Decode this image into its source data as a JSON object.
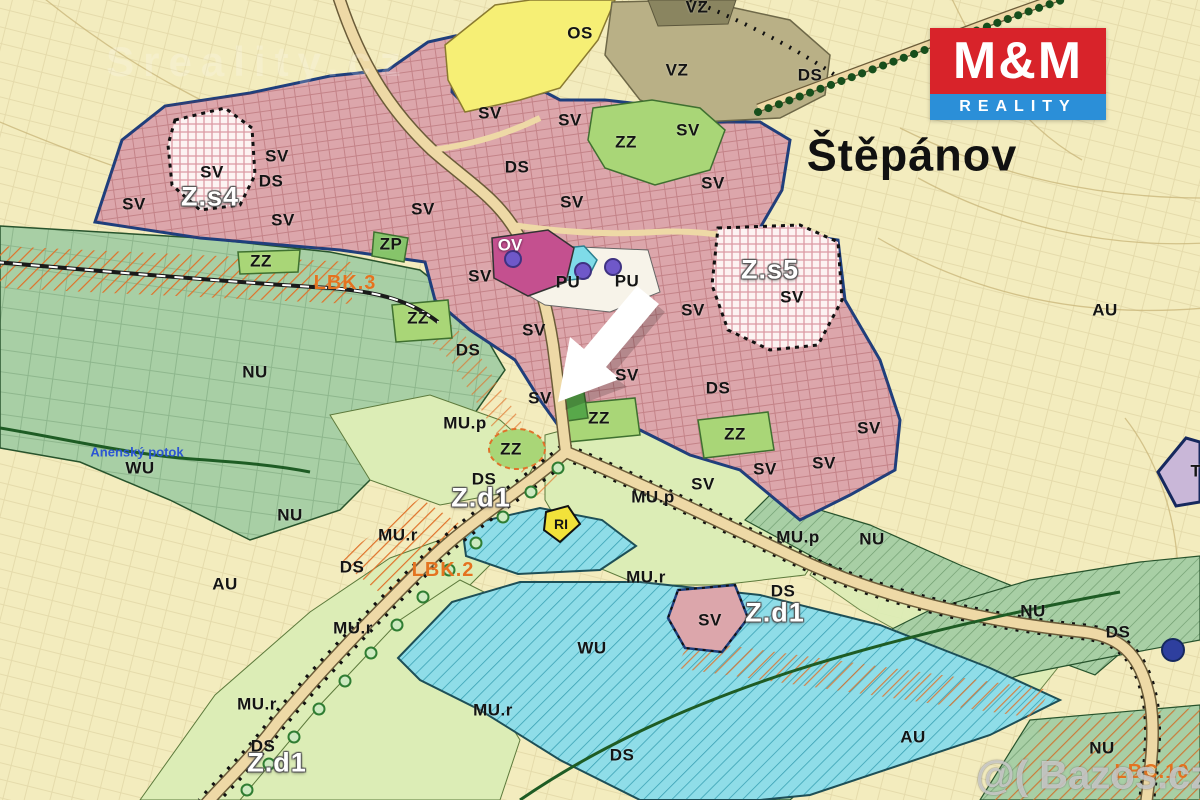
{
  "map": {
    "title": "Štěpánov",
    "logo": {
      "line1": "M&M",
      "line2": "REALITY",
      "red": "#d8232a",
      "blue": "#2b8fd8"
    },
    "watermarks": {
      "top_left": "Sreality.cz",
      "bottom_right": "@( Bazos.cz"
    },
    "colors": {
      "sv_pink": "#dca6ab",
      "nu_sage": "#a8cfa5",
      "mu_pale_green": "#dcedb6",
      "zz_green": "#a9d677",
      "zp_green": "#86c46a",
      "wu_cyan": "#8fdde8",
      "os_yellow": "#f6ef75",
      "vz_khaki": "#b9b086",
      "ov_magenta": "#c4508f",
      "pu_white": "#f7f3e9",
      "au_cream": "#f3ecbe",
      "road_tan": "#eed9a6",
      "corridor_orange": "#e0722a",
      "boundary_navy": "#1e3f7d",
      "ri_yellow": "#f2e23a",
      "t_lavender": "#c9b7d8",
      "marker_purple": "#6f58c9",
      "marker_blue": "#2e3f9e",
      "arrow_white": "#ffffff"
    },
    "labels": [
      {
        "t": "OS",
        "x": 580,
        "y": 33,
        "k": "zone"
      },
      {
        "t": "VZ",
        "x": 697,
        "y": 7,
        "k": "zone"
      },
      {
        "t": "VZ",
        "x": 677,
        "y": 70,
        "k": "zone"
      },
      {
        "t": "DS",
        "x": 810,
        "y": 75,
        "k": "zone"
      },
      {
        "t": "SV",
        "x": 490,
        "y": 113,
        "k": "zone"
      },
      {
        "t": "SV",
        "x": 570,
        "y": 120,
        "k": "zone"
      },
      {
        "t": "SV",
        "x": 688,
        "y": 130,
        "k": "zone"
      },
      {
        "t": "ZZ",
        "x": 626,
        "y": 142,
        "k": "zone"
      },
      {
        "t": "SV",
        "x": 277,
        "y": 156,
        "k": "zone"
      },
      {
        "t": "DS",
        "x": 517,
        "y": 167,
        "k": "zone"
      },
      {
        "t": "SV",
        "x": 212,
        "y": 172,
        "k": "zone"
      },
      {
        "t": "DS",
        "x": 271,
        "y": 181,
        "k": "zone"
      },
      {
        "t": "SV",
        "x": 713,
        "y": 183,
        "k": "zone"
      },
      {
        "t": "Z.s4",
        "x": 210,
        "y": 197,
        "k": "white"
      },
      {
        "t": "SV",
        "x": 134,
        "y": 204,
        "k": "zone"
      },
      {
        "t": "SV",
        "x": 423,
        "y": 209,
        "k": "zone"
      },
      {
        "t": "SV",
        "x": 283,
        "y": 220,
        "k": "zone"
      },
      {
        "t": "SV",
        "x": 572,
        "y": 202,
        "k": "zone"
      },
      {
        "t": "ZP",
        "x": 391,
        "y": 244,
        "k": "zone"
      },
      {
        "t": "OV",
        "x": 510,
        "y": 245,
        "k": "ltwhite"
      },
      {
        "t": "ZZ",
        "x": 261,
        "y": 261,
        "k": "zone"
      },
      {
        "t": "Z.s5",
        "x": 770,
        "y": 270,
        "k": "white"
      },
      {
        "t": "LBK.3",
        "x": 345,
        "y": 283,
        "k": "orange"
      },
      {
        "t": "PU",
        "x": 568,
        "y": 282,
        "k": "zone"
      },
      {
        "t": "PU",
        "x": 627,
        "y": 281,
        "k": "zone"
      },
      {
        "t": "SV",
        "x": 480,
        "y": 276,
        "k": "zone"
      },
      {
        "t": "SV",
        "x": 792,
        "y": 297,
        "k": "zone"
      },
      {
        "t": "SV",
        "x": 693,
        "y": 310,
        "k": "zone"
      },
      {
        "t": "AU",
        "x": 1105,
        "y": 310,
        "k": "zone"
      },
      {
        "t": "ZZ",
        "x": 418,
        "y": 318,
        "k": "zone"
      },
      {
        "t": "SV",
        "x": 534,
        "y": 330,
        "k": "zone"
      },
      {
        "t": "DS",
        "x": 468,
        "y": 350,
        "k": "zone"
      },
      {
        "t": "NU",
        "x": 255,
        "y": 372,
        "k": "zone"
      },
      {
        "t": "SV",
        "x": 627,
        "y": 375,
        "k": "zone"
      },
      {
        "t": "DS",
        "x": 718,
        "y": 388,
        "k": "zone"
      },
      {
        "t": "SV",
        "x": 540,
        "y": 398,
        "k": "zone"
      },
      {
        "t": "ZZ",
        "x": 599,
        "y": 418,
        "k": "zone"
      },
      {
        "t": "MU.p",
        "x": 465,
        "y": 423,
        "k": "zone"
      },
      {
        "t": "SV",
        "x": 869,
        "y": 428,
        "k": "zone"
      },
      {
        "t": "ZZ",
        "x": 735,
        "y": 434,
        "k": "zone"
      },
      {
        "t": "ZZ",
        "x": 511,
        "y": 449,
        "k": "zone"
      },
      {
        "t": "Anenský potok",
        "x": 137,
        "y": 452,
        "k": "stream"
      },
      {
        "t": "SV",
        "x": 824,
        "y": 463,
        "k": "zone"
      },
      {
        "t": "WU",
        "x": 140,
        "y": 468,
        "k": "zone"
      },
      {
        "t": "SV",
        "x": 765,
        "y": 469,
        "k": "zone"
      },
      {
        "t": "T",
        "x": 1196,
        "y": 471,
        "k": "zone"
      },
      {
        "t": "DS",
        "x": 484,
        "y": 479,
        "k": "zone"
      },
      {
        "t": "SV",
        "x": 703,
        "y": 484,
        "k": "zone"
      },
      {
        "t": "Z.d1",
        "x": 481,
        "y": 498,
        "k": "white"
      },
      {
        "t": "MU.p",
        "x": 653,
        "y": 497,
        "k": "zone"
      },
      {
        "t": "NU",
        "x": 290,
        "y": 515,
        "k": "zone"
      },
      {
        "t": "RI",
        "x": 561,
        "y": 524,
        "k": "small"
      },
      {
        "t": "MU.r",
        "x": 398,
        "y": 535,
        "k": "zone"
      },
      {
        "t": "MU.p",
        "x": 798,
        "y": 537,
        "k": "zone"
      },
      {
        "t": "NU",
        "x": 872,
        "y": 539,
        "k": "zone"
      },
      {
        "t": "DS",
        "x": 352,
        "y": 567,
        "k": "zone"
      },
      {
        "t": "LBK.2",
        "x": 443,
        "y": 570,
        "k": "orange"
      },
      {
        "t": "MU.r",
        "x": 646,
        "y": 577,
        "k": "zone"
      },
      {
        "t": "AU",
        "x": 225,
        "y": 584,
        "k": "zone"
      },
      {
        "t": "DS",
        "x": 783,
        "y": 591,
        "k": "zone"
      },
      {
        "t": "NU",
        "x": 1033,
        "y": 611,
        "k": "zone"
      },
      {
        "t": "Z.d1",
        "x": 775,
        "y": 613,
        "k": "white"
      },
      {
        "t": "SV",
        "x": 710,
        "y": 620,
        "k": "zone"
      },
      {
        "t": "MU.r",
        "x": 353,
        "y": 628,
        "k": "zone"
      },
      {
        "t": "DS",
        "x": 1118,
        "y": 632,
        "k": "zone"
      },
      {
        "t": "WU",
        "x": 592,
        "y": 648,
        "k": "zone"
      },
      {
        "t": "MU.r",
        "x": 257,
        "y": 704,
        "k": "zone"
      },
      {
        "t": "MU.r",
        "x": 493,
        "y": 710,
        "k": "zone"
      },
      {
        "t": "AU",
        "x": 913,
        "y": 737,
        "k": "zone"
      },
      {
        "t": "DS",
        "x": 263,
        "y": 746,
        "k": "zone"
      },
      {
        "t": "NU",
        "x": 1102,
        "y": 748,
        "k": "zone"
      },
      {
        "t": "DS",
        "x": 622,
        "y": 755,
        "k": "zone"
      },
      {
        "t": "Z.d1",
        "x": 277,
        "y": 763,
        "k": "white"
      },
      {
        "t": "LBC.10",
        "x": 1152,
        "y": 772,
        "k": "orange"
      }
    ]
  }
}
